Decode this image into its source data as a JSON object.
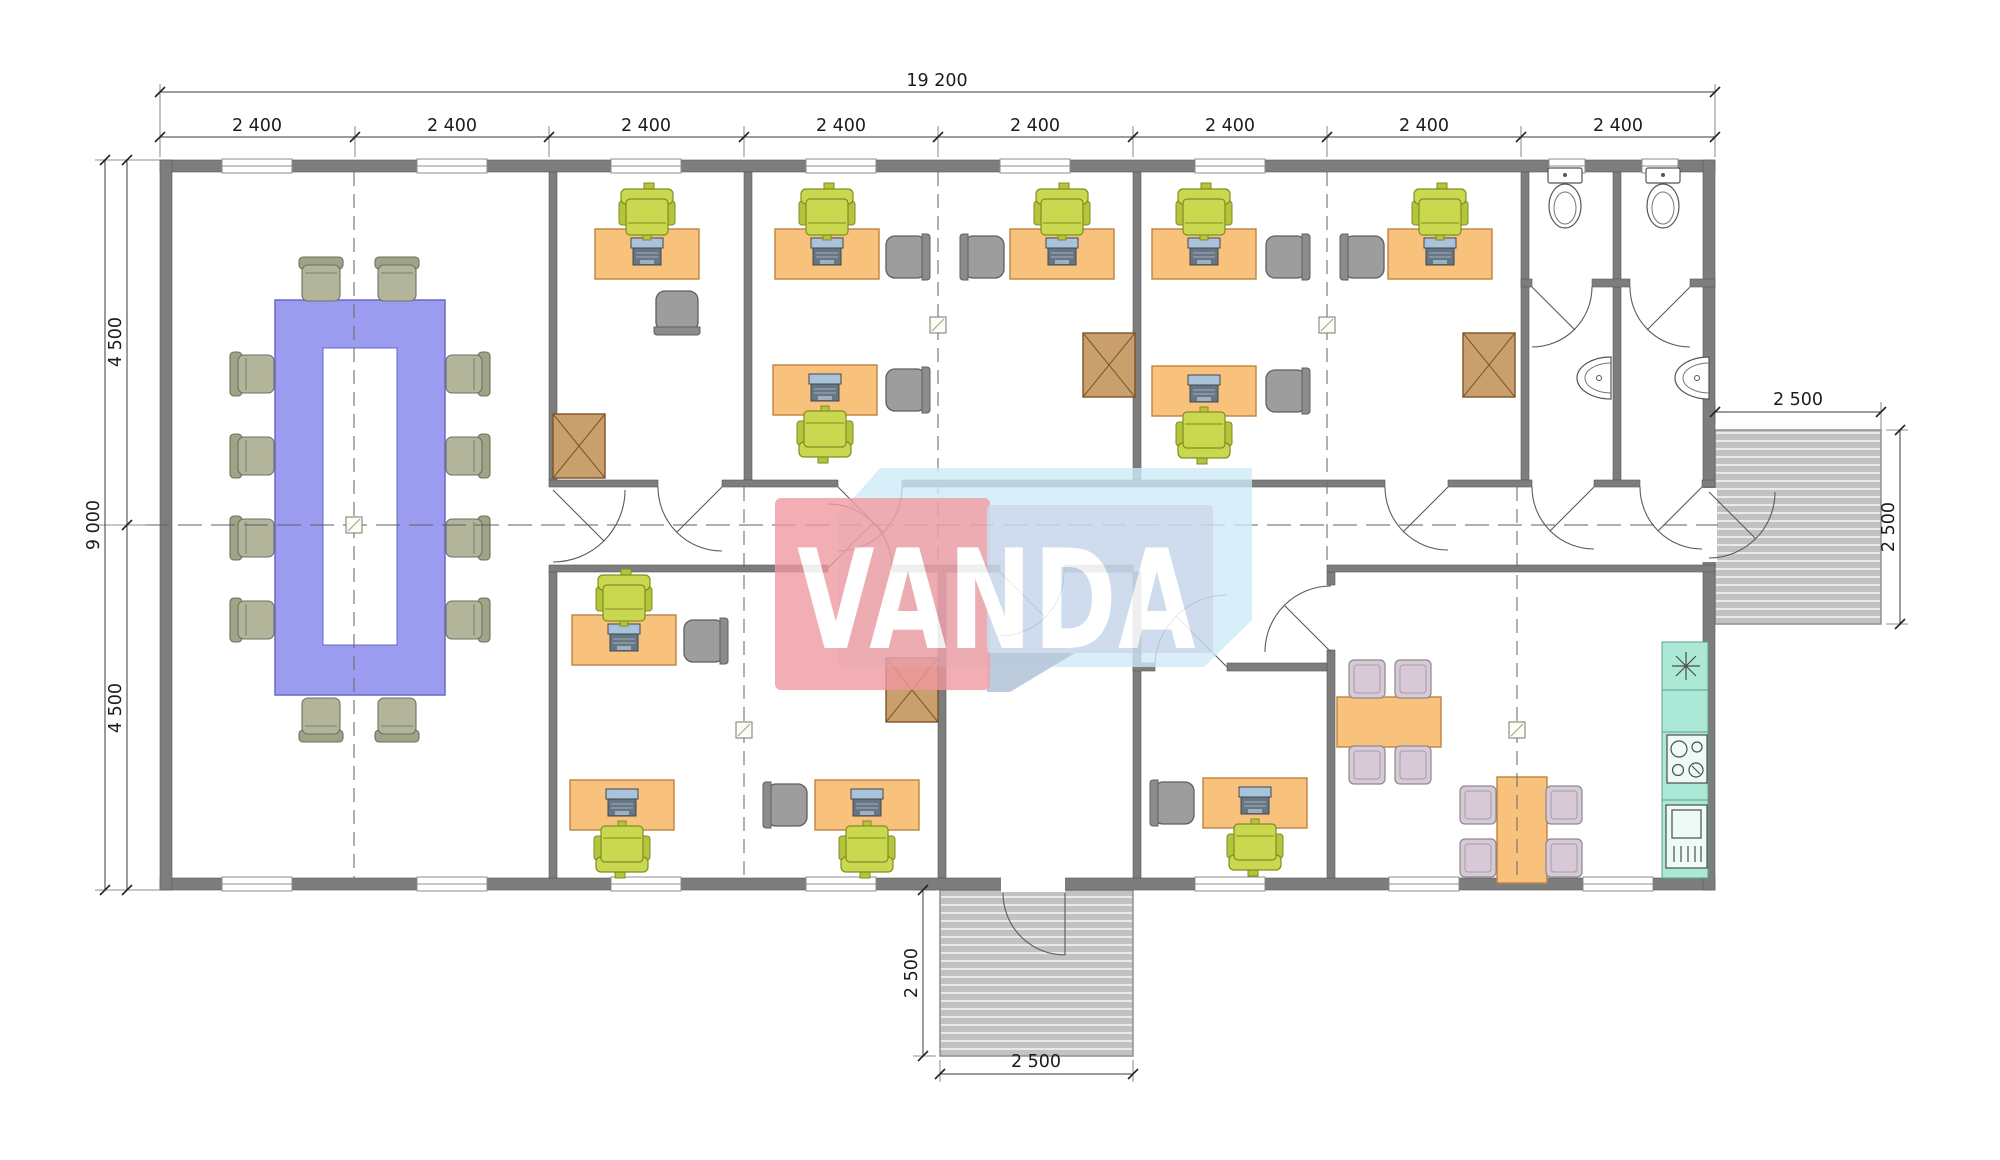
{
  "watermark": {
    "text": "VANDA"
  },
  "dimensions": {
    "total_width": "19 200",
    "modules": [
      "2 400",
      "2 400",
      "2 400",
      "2 400",
      "2 400",
      "2 400",
      "2 400",
      "2 400"
    ],
    "total_height": "9 000",
    "height_halves": [
      "4 500",
      "4 500"
    ],
    "right_porch": {
      "width": "2 500",
      "depth": "2 500"
    },
    "bottom_porch": {
      "width": "2 500",
      "depth": "2 500"
    }
  },
  "colors": {
    "wall": "#7d7d7d",
    "desk": "#f9c27c",
    "chair_green": "#c9d84f",
    "chair_gray": "#9d9d9d",
    "chair_conf": "#b2b59a",
    "chair_dine": "#d8c9d6",
    "conference_table": "#9b9bef",
    "cabinet": "#c9a06d",
    "kitchen": "#abe8d5",
    "deck": "#c2c2c2",
    "watermark_red": "#ee98a0",
    "watermark_blue": "#c6d5e9",
    "watermark_lightblue": "#cdeaf8"
  }
}
